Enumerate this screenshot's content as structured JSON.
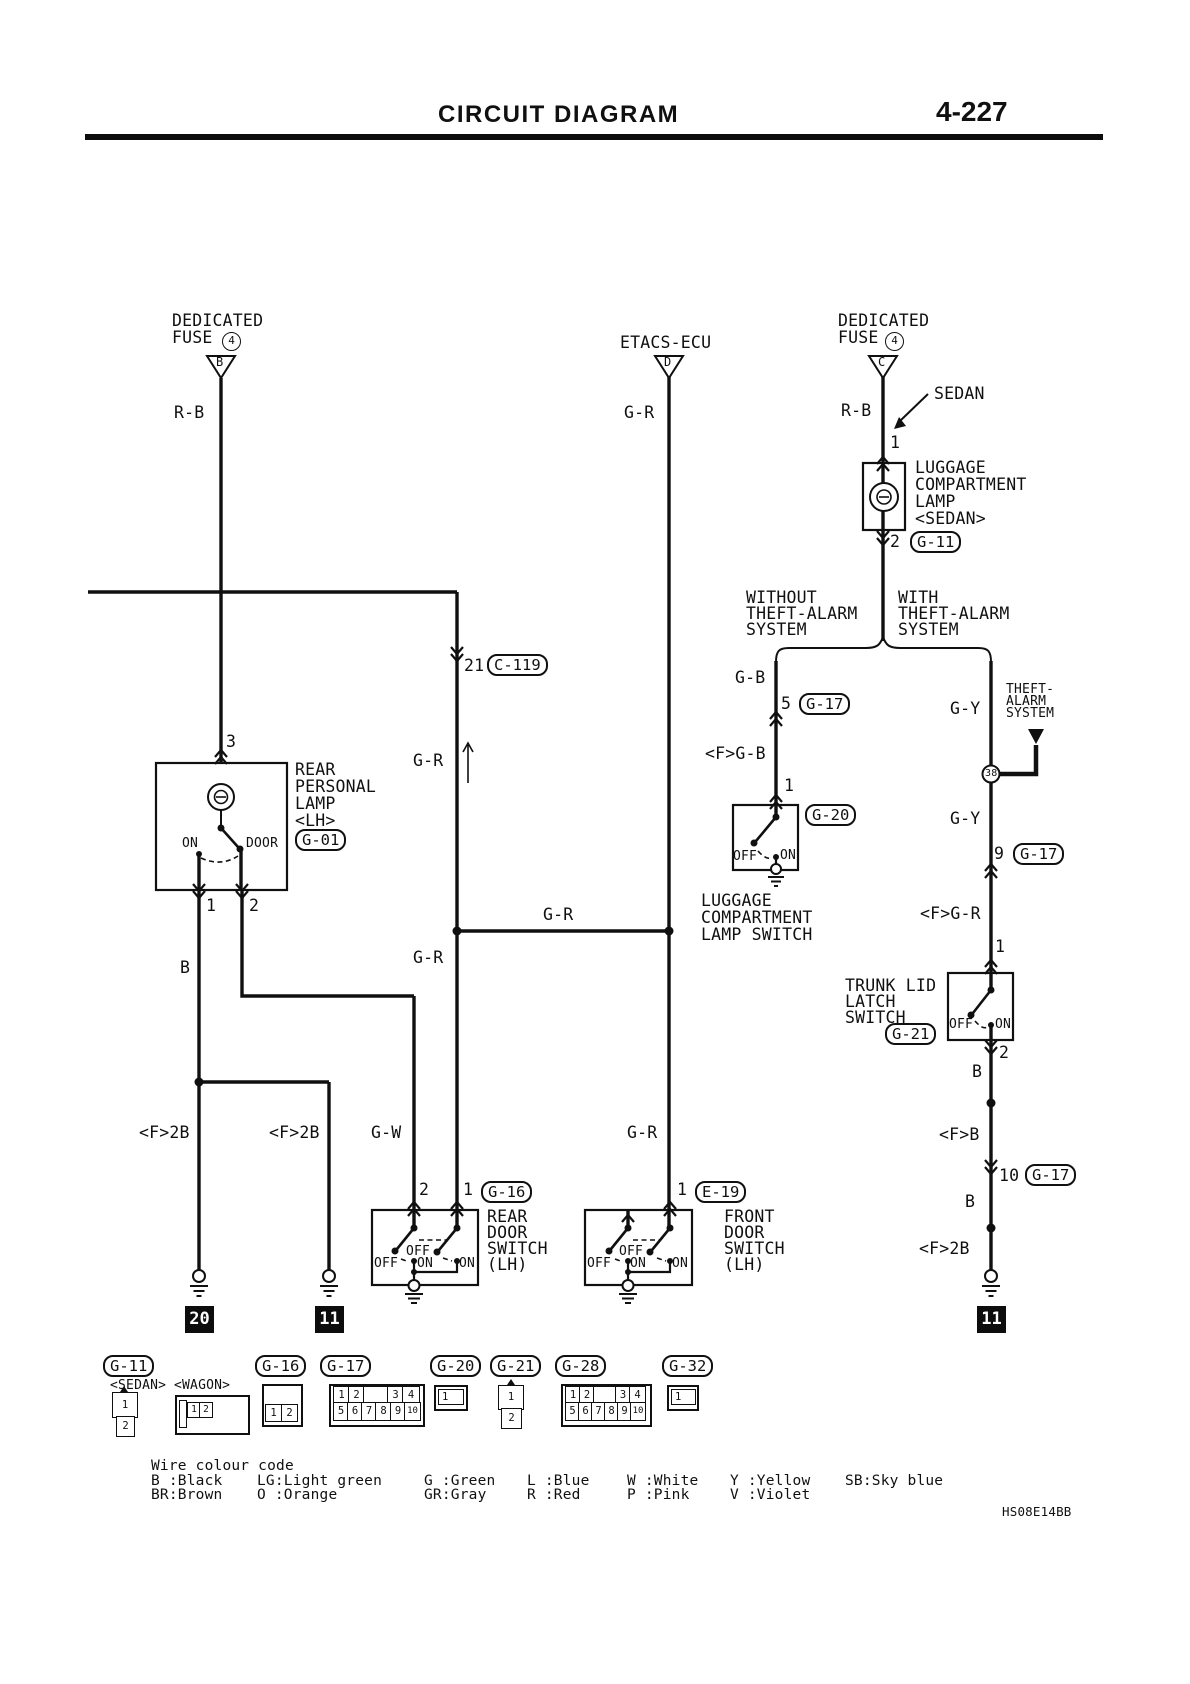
{
  "header": {
    "title": "CIRCUIT DIAGRAM",
    "page": "4-227"
  },
  "power_feeds": {
    "fuse_left": {
      "name1": "DEDICATED",
      "name2": "FUSE",
      "number": "4",
      "terminal": "B",
      "wire": "R-B"
    },
    "etacs": {
      "name": "ETACS-ECU",
      "terminal": "D",
      "wire": "G-R"
    },
    "fuse_right": {
      "name1": "DEDICATED",
      "name2": "FUSE",
      "number": "4",
      "terminal": "C",
      "wire": "R-B",
      "variant": "SEDAN"
    }
  },
  "luggage_lamp": {
    "pin_in": "1",
    "name1": "LUGGAGE",
    "name2": "COMPARTMENT",
    "name3": "LAMP",
    "name4": "<SEDAN>",
    "pin_out": "2",
    "connector": "G-11"
  },
  "branches": {
    "without1": "WITHOUT",
    "without2": "THEFT-ALARM",
    "without3": "SYSTEM",
    "with1": "WITH",
    "with2": "THEFT-ALARM",
    "with3": "SYSTEM"
  },
  "luggage_lamp_switch": {
    "wire_in": "G-B",
    "g17_pin": "5",
    "g17_ref": "G-17",
    "wire_f": "<F>G-B",
    "pin_in": "1",
    "connector": "G-20",
    "off": "OFF",
    "on": "ON",
    "name1": "LUGGAGE",
    "name2": "COMPARTMENT",
    "name3": "LAMP SWITCH"
  },
  "theft_alarm": {
    "wire1": "G-Y",
    "tag1": "THEFT-",
    "tag2": "ALARM",
    "tag3": "SYSTEM",
    "junction": "38",
    "wire2": "G-Y",
    "g17_pin": "9",
    "g17_ref": "G-17"
  },
  "trunk_lid_latch_switch": {
    "wire_f": "<F>G-R",
    "pin_in": "1",
    "name1": "TRUNK LID",
    "name2": "LATCH",
    "name3": "SWITCH",
    "connector": "G-21",
    "off": "OFF",
    "on": "ON",
    "pin_out": "2",
    "wire_b1": "B",
    "wire_fb": "<F>B",
    "g17_pin": "10",
    "g17_ref": "G-17",
    "wire_b2": "B",
    "wire_f2b": "<F>2B",
    "ground": "11"
  },
  "rear_personal_lamp": {
    "pin_in": "3",
    "name1": "REAR",
    "name2": "PERSONAL",
    "name3": "LAMP",
    "name4": "<LH>",
    "connector": "G-01",
    "pos_on": "ON",
    "pos_door": "DOOR",
    "pin1": "1",
    "pin2": "2",
    "wire_b": "B",
    "wire_f2b_a": "<F>2B",
    "wire_f2b_b": "<F>2B",
    "ground_a": "20",
    "ground_b": "11"
  },
  "junctions": {
    "c119_pin": "21",
    "c119_ref": "C-119",
    "wire_up": "G-R",
    "gr_link": "G-R",
    "gr_down": "G-R"
  },
  "rear_door_switch": {
    "wire_gw": "G-W",
    "pin2": "2",
    "pin1": "1",
    "connector": "G-16",
    "name1": "REAR",
    "name2": "DOOR",
    "name3": "SWITCH",
    "name4": "(LH)",
    "off_a": "OFF",
    "off_b": "OFF",
    "on_a": "ON",
    "on_b": "ON"
  },
  "front_door_switch": {
    "wire_gr": "G-R",
    "pin1": "1",
    "connector": "E-19",
    "name1": "FRONT",
    "name2": "DOOR",
    "name3": "SWITCH",
    "name4": "(LH)",
    "off_a": "OFF",
    "off_b": "OFF",
    "on_a": "ON",
    "on_b": "ON"
  },
  "connector_legend": {
    "g11": {
      "ref": "G-11",
      "sedan": "<SEDAN>",
      "wagon": "<WAGON>",
      "sedan_pin1": "1",
      "sedan_pin2": "2",
      "wagon_pin1": "1",
      "wagon_pin2": "2"
    },
    "g16": {
      "ref": "G-16",
      "pin1": "1",
      "pin2": "2"
    },
    "g17": {
      "ref": "G-17",
      "r1": [
        "1",
        "2",
        "3",
        "4"
      ],
      "r2": [
        "5",
        "6",
        "7",
        "8",
        "9",
        "10"
      ]
    },
    "g20": {
      "ref": "G-20",
      "pin1": "1"
    },
    "g21": {
      "ref": "G-21",
      "pin1": "1",
      "pin2": "2"
    },
    "g28": {
      "ref": "G-28",
      "r1": [
        "1",
        "2",
        "3",
        "4"
      ],
      "r2": [
        "5",
        "6",
        "7",
        "8",
        "9",
        "10"
      ]
    },
    "g32": {
      "ref": "G-32",
      "pin1": "1"
    }
  },
  "wire_colour_code": {
    "title": "Wire colour code",
    "row1": [
      "B :Black",
      "LG:Light green",
      "G :Green",
      "L :Blue",
      "W :White",
      "Y :Yellow",
      "SB:Sky blue"
    ],
    "row2": [
      "BR:Brown",
      "O :Orange",
      "GR:Gray",
      "R :Red",
      "P :Pink",
      "V :Violet"
    ]
  },
  "doc_code": "HS08E14BB"
}
